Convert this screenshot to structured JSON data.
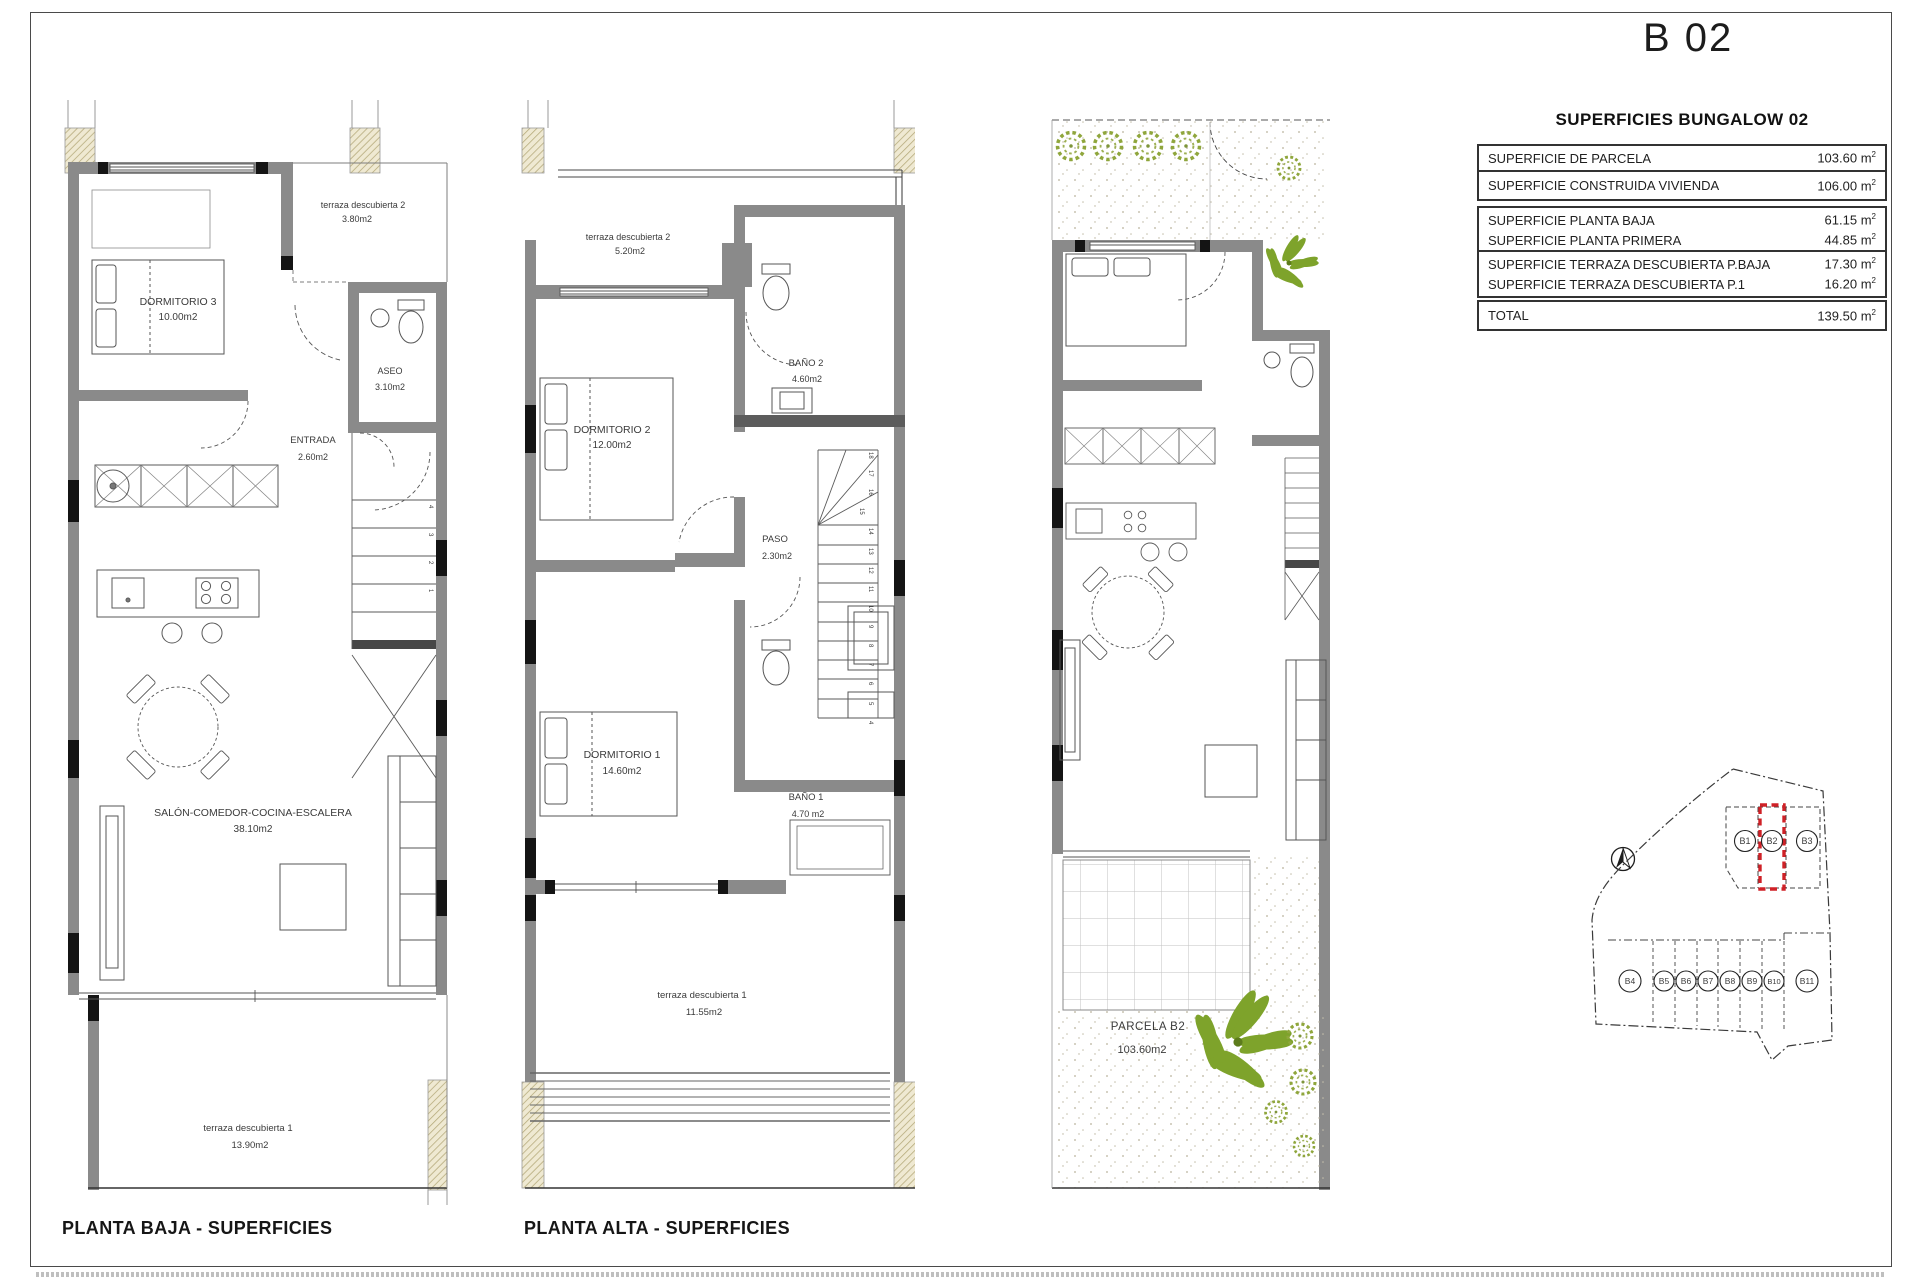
{
  "title": "B 02",
  "table": {
    "header": "SUPERFICIES BUNGALOW 02",
    "unit": "m",
    "sup": "2",
    "rows": [
      {
        "label": "SUPERFICIE DE PARCELA",
        "value": "103.60"
      },
      {
        "label": "SUPERFICIE CONSTRUIDA VIVIENDA",
        "value": "106.00"
      },
      {
        "label": "SUPERFICIE PLANTA BAJA",
        "value": "61.15"
      },
      {
        "label": "SUPERFICIE PLANTA PRIMERA",
        "value": "44.85"
      },
      {
        "label": "SUPERFICIE TERRAZA DESCUBIERTA P.BAJA",
        "value": "17.30"
      },
      {
        "label": "SUPERFICIE TERRAZA DESCUBIERTA P.1",
        "value": "16.20"
      },
      {
        "label": "TOTAL",
        "value": "139.50"
      }
    ]
  },
  "plans": {
    "baja": {
      "caption": "PLANTA BAJA - SUPERFICIES",
      "rooms": {
        "dormitorio3": {
          "name": "DORMITORIO 3",
          "area": "10.00m2"
        },
        "terraza2": {
          "name": "terraza descubierta 2",
          "area": "3.80m2"
        },
        "aseo": {
          "name": "ASEO",
          "area": "3.10m2"
        },
        "entrada": {
          "name": "ENTRADA",
          "area": "2.60m2"
        },
        "salon": {
          "name": "SALÓN-COMEDOR-COCINA-ESCALERA",
          "area": "38.10m2"
        },
        "terraza1": {
          "name": "terraza descubierta 1",
          "area": "13.90m2"
        }
      },
      "stair_numbers": [
        "4",
        "3",
        "2",
        "1"
      ]
    },
    "alta": {
      "caption": "PLANTA ALTA - SUPERFICIES",
      "rooms": {
        "terraza2": {
          "name": "terraza descubierta 2",
          "area": "5.20m2"
        },
        "dormitorio2": {
          "name": "DORMITORIO 2",
          "area": "12.00m2"
        },
        "bano2": {
          "name": "BAÑO 2",
          "area": "4.60m2"
        },
        "paso": {
          "name": "PASO",
          "area": "2.30m2"
        },
        "dormitorio1": {
          "name": "DORMITORIO 1",
          "area": "14.60m2"
        },
        "bano1": {
          "name": "BAÑO 1",
          "area": "4.70 m2"
        },
        "terraza1": {
          "name": "terraza descubierta 1",
          "area": "11.55m2"
        }
      },
      "stair_numbers": [
        "18",
        "17",
        "16",
        "15",
        "14",
        "13",
        "12",
        "11",
        "10",
        "9",
        "8",
        "7",
        "6",
        "5",
        "4"
      ]
    },
    "parcela": {
      "label": "PARCELA B2",
      "area": "103.60m2"
    }
  },
  "site": {
    "top_units": [
      "B1",
      "B2",
      "B3"
    ],
    "bottom_units": [
      "B4",
      "B5",
      "B6",
      "B7",
      "B8",
      "B9",
      "B10",
      "B11"
    ],
    "highlighted_unit": "B2",
    "highlight_color": "#cf2127"
  },
  "colors": {
    "wall_gray": "#8a8a8a",
    "accent_red": "#cf2127",
    "plant_green": "#7ea32b",
    "hatch_beige": "#efe9d2"
  }
}
